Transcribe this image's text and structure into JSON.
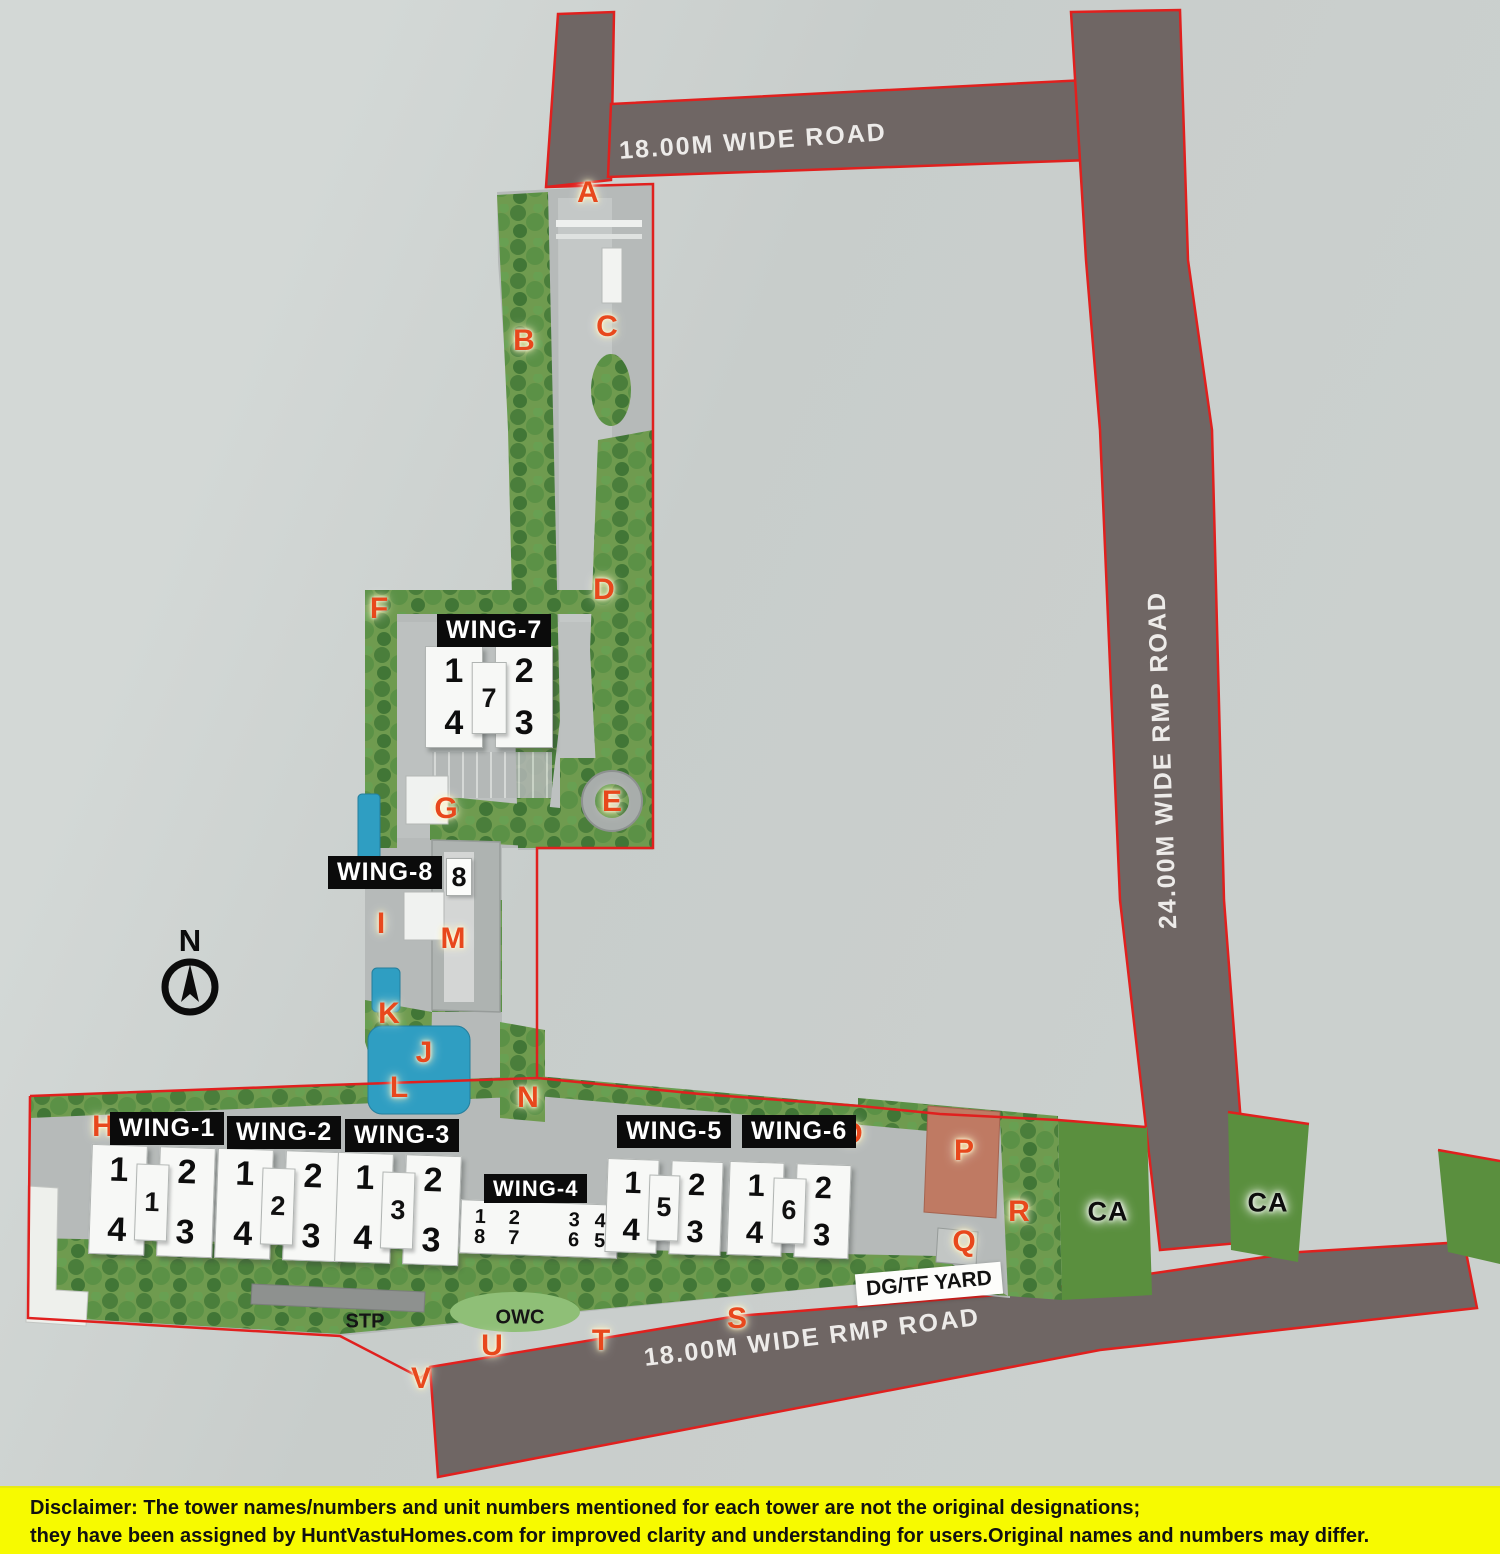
{
  "roads": {
    "top": "18.00M WIDE ROAD",
    "right": "24.00M WIDE RMP ROAD",
    "bottom": "18.00M WIDE RMP ROAD"
  },
  "compass": {
    "north": "N"
  },
  "wings": [
    {
      "label": "WING-1",
      "units": {
        "tl": "1",
        "tr": "2",
        "br": "3",
        "bl": "4",
        "core": "1"
      }
    },
    {
      "label": "WING-2",
      "units": {
        "tl": "1",
        "tr": "2",
        "br": "3",
        "bl": "4",
        "core": "2"
      }
    },
    {
      "label": "WING-3",
      "units": {
        "tl": "1",
        "tr": "2",
        "br": "3",
        "bl": "4",
        "core": "3"
      }
    },
    {
      "label": "WING-4",
      "pairs": [
        [
          "1",
          "8"
        ],
        [
          "2",
          "7"
        ],
        [
          "3",
          "6"
        ],
        [
          "4",
          "5"
        ]
      ]
    },
    {
      "label": "WING-5",
      "units": {
        "tl": "1",
        "tr": "2",
        "br": "3",
        "bl": "4",
        "core": "5"
      }
    },
    {
      "label": "WING-6",
      "units": {
        "tl": "1",
        "tr": "2",
        "br": "3",
        "bl": "4",
        "core": "6"
      }
    },
    {
      "label": "WING-7",
      "units": {
        "tl": "1",
        "tr": "2",
        "br": "3",
        "bl": "4",
        "core": "7"
      }
    },
    {
      "label": "WING-8",
      "units": {
        "core": "8"
      }
    }
  ],
  "markers": {
    "A": "A",
    "B": "B",
    "C": "C",
    "D": "D",
    "E": "E",
    "F": "F",
    "G": "G",
    "H": "H",
    "I": "I",
    "J": "J",
    "K": "K",
    "L": "L",
    "M": "M",
    "N": "N",
    "O": "O",
    "P": "P",
    "Q": "Q",
    "R": "R",
    "S": "S",
    "T": "T",
    "U": "U",
    "V": "V"
  },
  "facilities": {
    "stp": "STP",
    "owc": "OWC",
    "dg_tf_yard": "DG/TF YARD",
    "ca_left": "CA",
    "ca_right": "CA"
  },
  "disclaimer": {
    "prefix": "Disclaimer:",
    "line1": " The tower names/numbers and unit numbers mentioned for each tower are not the original designations;",
    "line2": "they have been assigned by HuntVastuHomes.com for improved clarity and understanding for users.Original names and numbers may differ."
  },
  "colors": {
    "boundary_red": "#e0201e",
    "marker_red": "#e8481c",
    "road_fill": "#6f6664",
    "green": "#6f9b4f",
    "pool_blue": "#2f9ec2",
    "disclaimer_yellow": "#f7fa00"
  }
}
